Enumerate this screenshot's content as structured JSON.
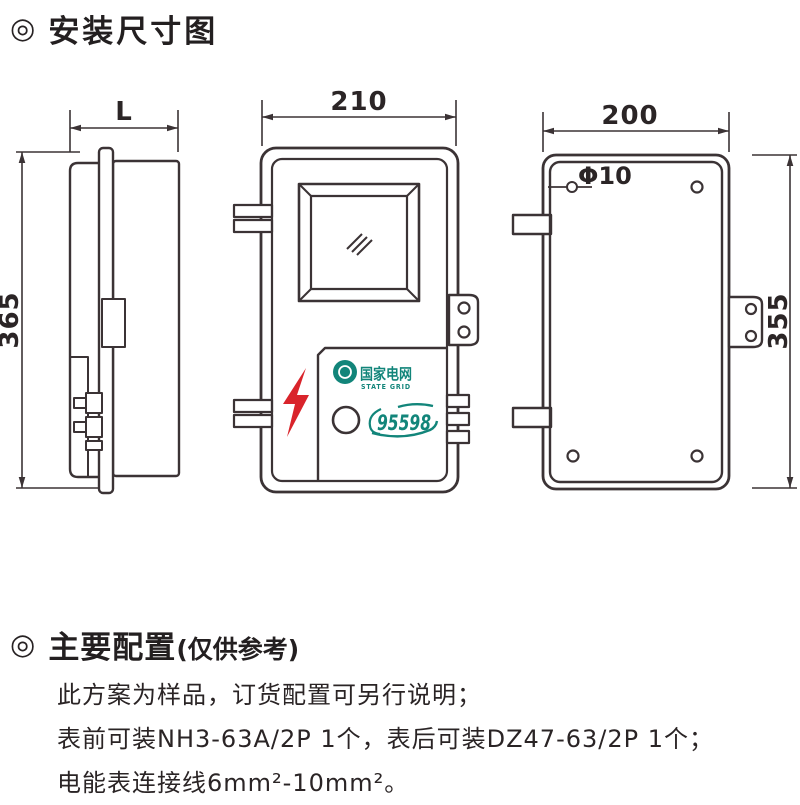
{
  "page": {
    "title_bullet": "◎",
    "title": "安装尺寸图"
  },
  "diagram": {
    "side_view": {
      "width_label": "L",
      "height_label": "365"
    },
    "front_view": {
      "width_label": "210",
      "logo": {
        "name": "国家电网",
        "subtitle": "STATE GRID",
        "hotline": "95598"
      }
    },
    "back_view": {
      "width_label": "200",
      "height_label": "355",
      "hole_label": "Φ10"
    },
    "colors": {
      "line": "#3b3335",
      "accent_red": "#d9242b",
      "brand_teal": "#12857a"
    }
  },
  "config_section": {
    "bullet": "◎",
    "heading": "主要配置",
    "heading_note": "(仅供参考)",
    "lines": [
      "此方案为样品，订货配置可另行说明；",
      "表前可装NH3-63A/2P 1个，表后可装DZ47-63/2P 1个；",
      "电能表连接线6mm²-10mm²。"
    ]
  }
}
